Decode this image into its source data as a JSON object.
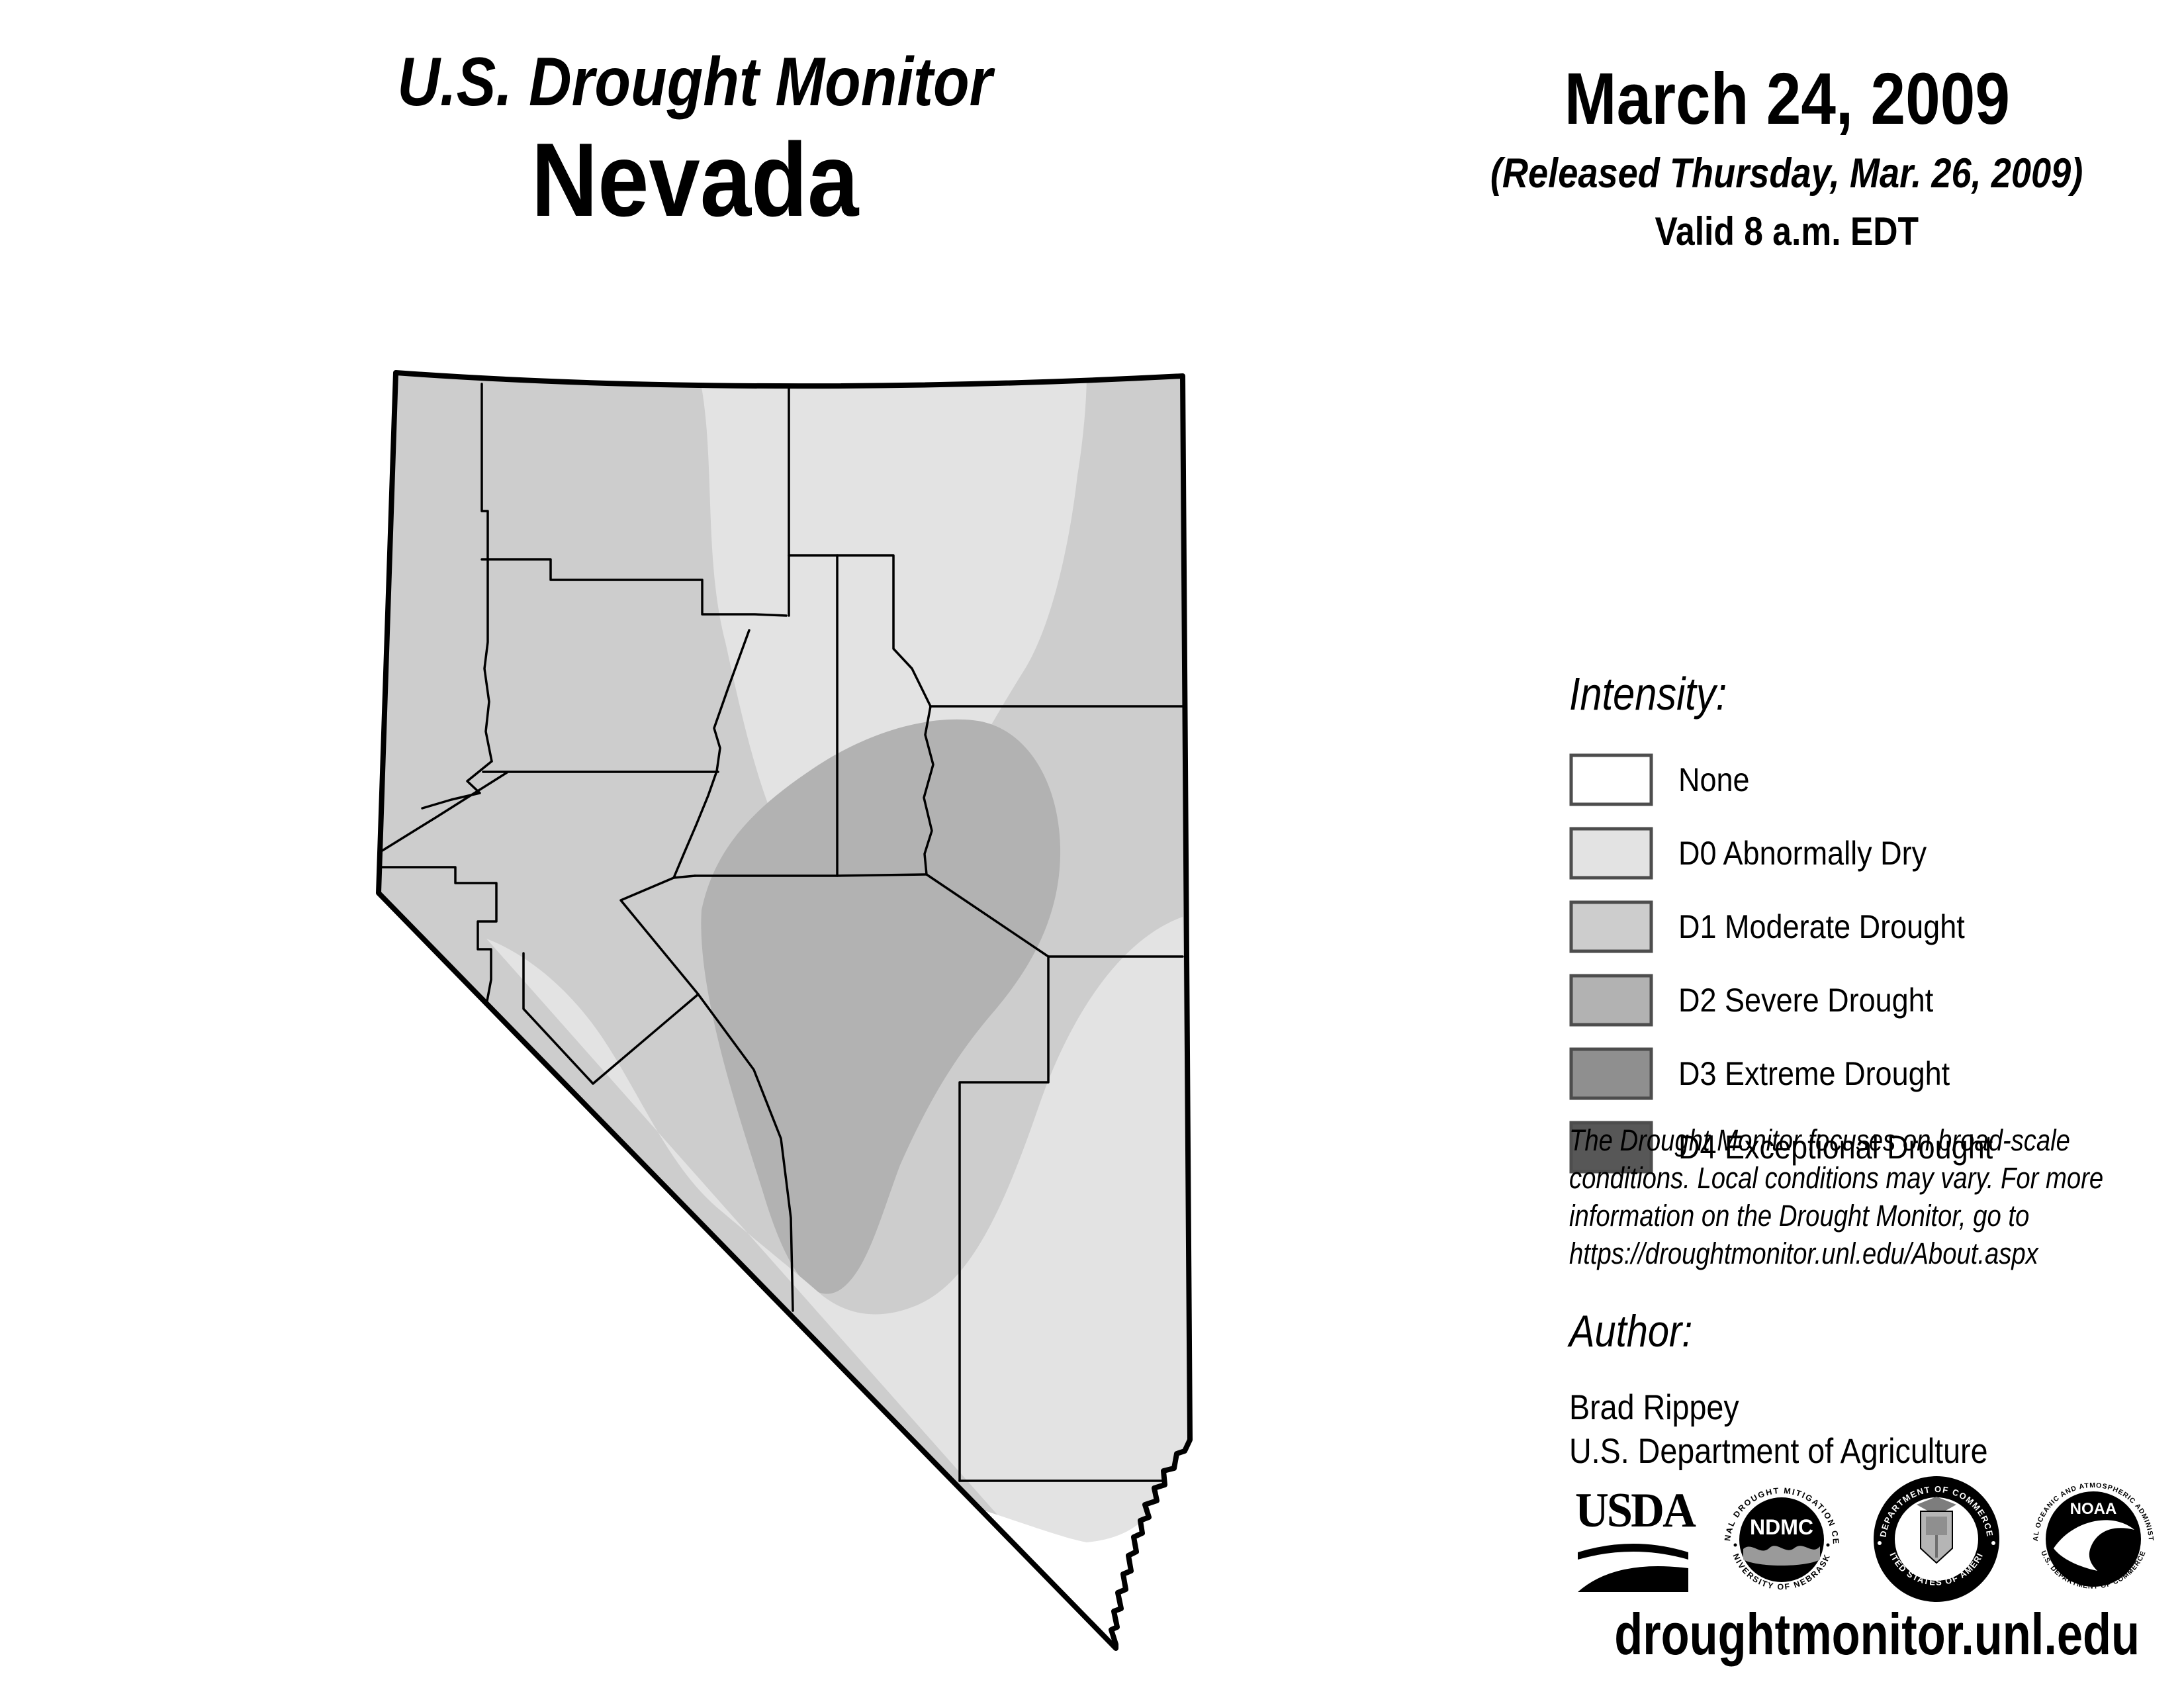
{
  "header": {
    "title": "U.S. Drought Monitor",
    "state": "Nevada",
    "date": "March 24, 2009",
    "released": "(Released Thursday, Mar. 26, 2009)",
    "valid": "Valid 8 a.m. EDT"
  },
  "legend": {
    "heading": "Intensity:",
    "items": [
      {
        "code": "none",
        "label": "None",
        "color": "#ffffff"
      },
      {
        "code": "D0",
        "label": "D0 Abnormally Dry",
        "color": "#e3e3e3"
      },
      {
        "code": "D1",
        "label": "D1 Moderate Drought",
        "color": "#cdcdcd"
      },
      {
        "code": "D2",
        "label": "D2 Severe Drought",
        "color": "#b2b2b2"
      },
      {
        "code": "D3",
        "label": "D3 Extreme Drought",
        "color": "#8f8f8f"
      },
      {
        "code": "D4",
        "label": "D4 Exceptional Drought",
        "color": "#575757"
      }
    ]
  },
  "map": {
    "border_color": "#000000",
    "regions": [
      {
        "name": "north-and-west-base",
        "level": "D1"
      },
      {
        "name": "northeast-lobe",
        "level": "D0"
      },
      {
        "name": "central-core",
        "level": "D2"
      },
      {
        "name": "southern-half",
        "level": "D0"
      },
      {
        "name": "far-southern-tip",
        "level": "none"
      }
    ]
  },
  "disclaimer": {
    "lines": [
      "The Drought Monitor focuses on broad-scale",
      "conditions. Local conditions may vary. For more",
      "information on the Drought Monitor, go to",
      "https://droughtmonitor.unl.edu/About.aspx"
    ]
  },
  "author": {
    "heading": "Author:",
    "name": "Brad Rippey",
    "org": "U.S. Department of Agriculture"
  },
  "footer": {
    "url": "droughtmonitor.unl.edu"
  },
  "logos": {
    "usda": {
      "text": "USDA"
    },
    "ndmc": {
      "text": "NDMC",
      "ring_top": "NATIONAL DROUGHT MITIGATION CENTER",
      "ring_bottom": "UNIVERSITY OF NEBRASKA"
    },
    "doc": {
      "ring_top": "DEPARTMENT OF COMMERCE",
      "ring_bottom": "UNITED STATES OF AMERICA"
    },
    "noaa": {
      "text": "NOAA",
      "ring_top": "NATIONAL OCEANIC AND ATMOSPHERIC ADMINISTRATION",
      "ring_bottom": "U.S. DEPARTMENT OF COMMERCE"
    }
  }
}
